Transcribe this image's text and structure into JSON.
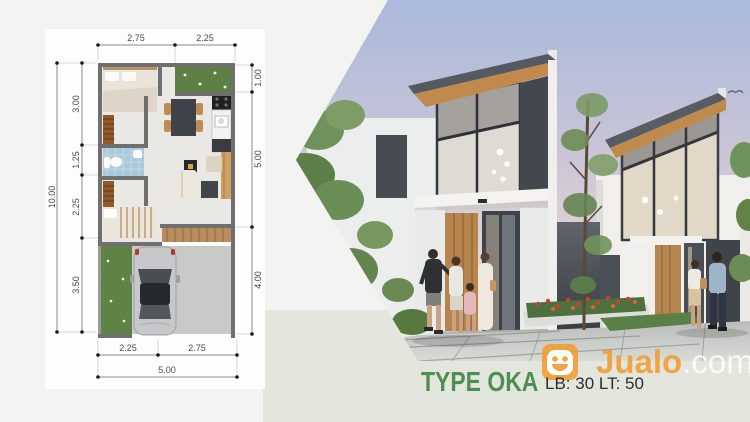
{
  "colors": {
    "green": "#4e8e51",
    "orange": "#f0a13d",
    "band": "#e2e6dc",
    "bg": "#f3f4f1",
    "card": "#fdfdfd"
  },
  "floor_plan": {
    "top_dims": [
      "2.75",
      "2.25"
    ],
    "left_total": "10.00",
    "left_dims": [
      "3.00",
      "1.25",
      "2.25",
      "3.50"
    ],
    "right_dims": [
      "1.00",
      "5.00",
      "4.00"
    ],
    "bottom_dims": [
      "2.25",
      "2.75"
    ],
    "bottom_total": "5.00"
  },
  "footer": {
    "type_label": "TYPE OKA",
    "specs": "LB: 30 LT: 50"
  },
  "watermark": {
    "brand": "Jualo",
    "tld": ".com"
  }
}
